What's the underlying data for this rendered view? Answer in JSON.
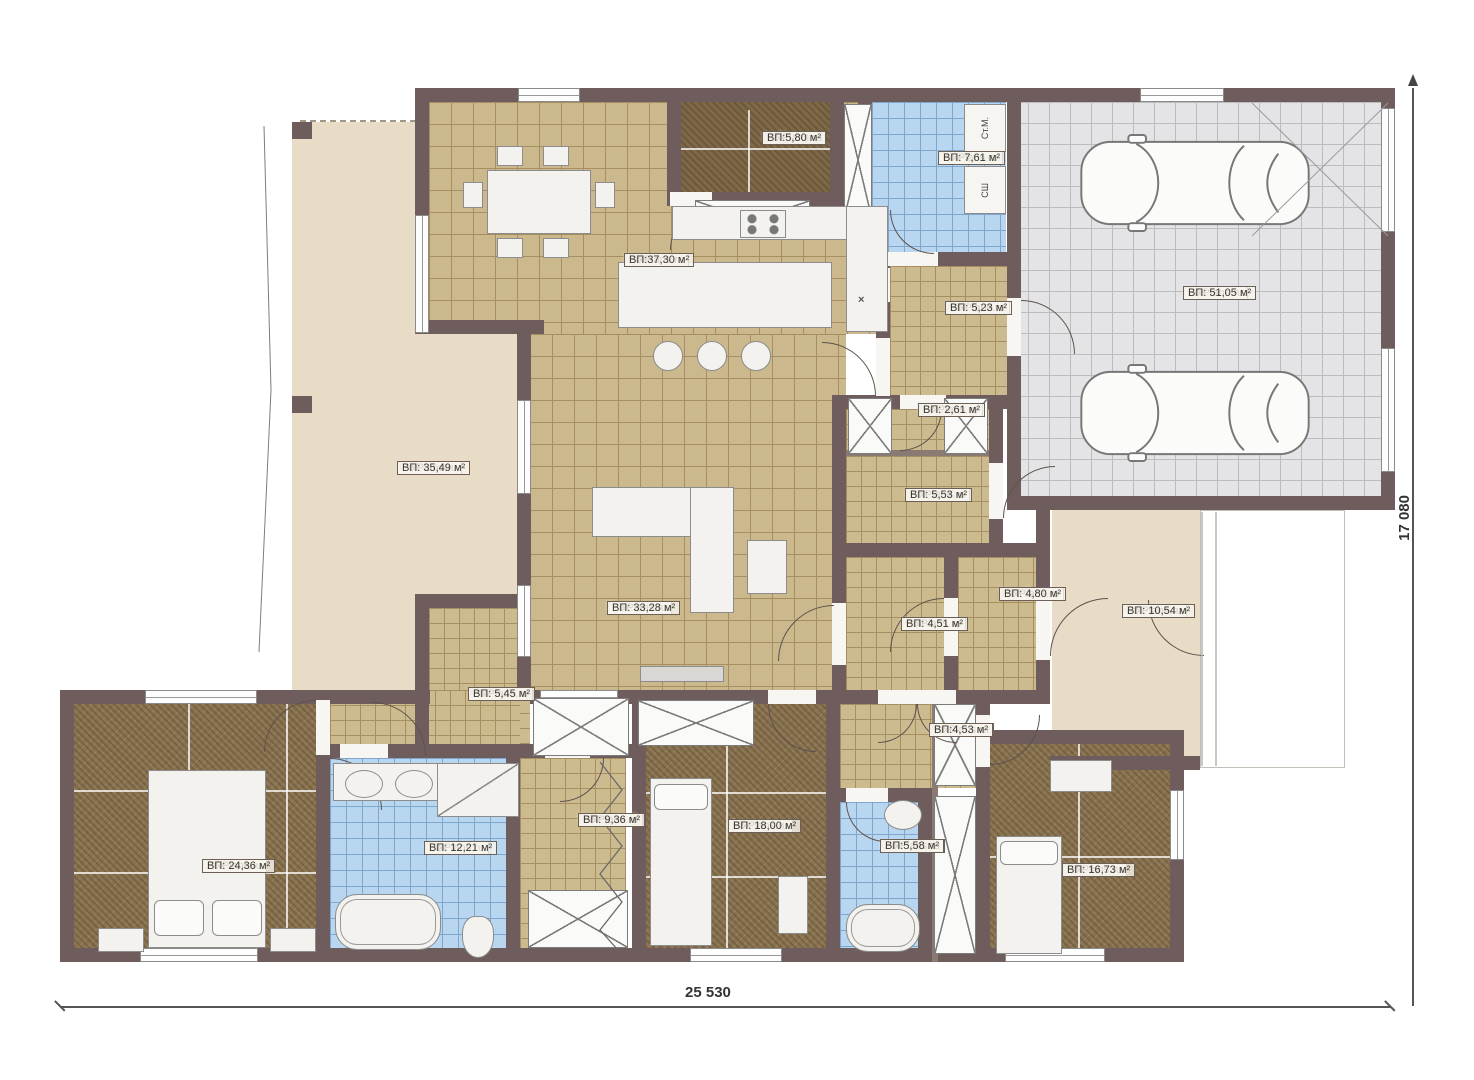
{
  "site": {
    "watermark": "FixPlans.ru"
  },
  "dimensions": {
    "bottom": "25 530",
    "right": "17 080"
  },
  "appliances": [
    {
      "label": "Ст.М.",
      "rect": [
        964,
        104,
        42,
        48
      ]
    },
    {
      "label": "СШ",
      "rect": [
        964,
        166,
        42,
        48
      ]
    }
  ],
  "kitchen_sink_symbol": "×",
  "rooms": [
    {
      "id": "terrace",
      "name": "Терасса",
      "area": "ВП: 35,49 м²",
      "floor": "f-beige",
      "rect": [
        292,
        122,
        238,
        568
      ],
      "label": [
        397,
        460
      ]
    },
    {
      "id": "kitchen",
      "name": "Кухня",
      "area": "ВП:37,30 м²",
      "floor": "f-tan",
      "rect": [
        429,
        102,
        460,
        232
      ],
      "label": [
        624,
        252
      ]
    },
    {
      "id": "kabinet",
      "name": "Кабинет",
      "area": "ВП:5,80 м²",
      "floor": "f-carpetd",
      "rect": [
        681,
        102,
        149,
        90
      ],
      "label": [
        762,
        130
      ]
    },
    {
      "id": "laundry",
      "name": "Прачечная",
      "area": "ВП: 7,61 м²",
      "floor": "f-blue",
      "rect": [
        872,
        102,
        134,
        150
      ],
      "label": [
        938,
        150
      ]
    },
    {
      "id": "garage",
      "name": "Гараж",
      "area": "ВП: 51,05 м²",
      "floor": "f-gray",
      "rect": [
        1007,
        102,
        374,
        394
      ],
      "label": [
        1183,
        285
      ]
    },
    {
      "id": "hall523",
      "name": "Холл",
      "area": "ВП: 5,23 м²",
      "floor": "f-tansm",
      "rect": [
        890,
        266,
        117,
        129
      ],
      "label": [
        945,
        300
      ]
    },
    {
      "id": "klad261",
      "name": "Кладовая",
      "area": "ВП: 2,61 м²",
      "floor": "f-tansm",
      "rect": [
        846,
        409,
        143,
        41
      ],
      "label": [
        918,
        402
      ]
    },
    {
      "id": "klad553",
      "name": "Кладовая",
      "area": "ВП: 5,53 м²",
      "floor": "f-tansm",
      "rect": [
        846,
        456,
        143,
        87
      ],
      "label": [
        905,
        487
      ]
    },
    {
      "id": "gostinaya",
      "name": "Гостиная",
      "area": "ВП: 33,28 м²",
      "floor": "f-tan",
      "rect": [
        530,
        334,
        316,
        356
      ],
      "label": [
        607,
        600
      ]
    },
    {
      "id": "hall451",
      "name": "Холл",
      "area": "ВП: 4,51 м²",
      "floor": "f-tansm",
      "rect": [
        846,
        557,
        98,
        133
      ],
      "label": [
        901,
        616
      ]
    },
    {
      "id": "tambur",
      "name": "Тамбур",
      "area": "ВП: 4,80 м²",
      "floor": "f-tansm",
      "rect": [
        958,
        557,
        78,
        133
      ],
      "label": [
        999,
        586
      ]
    },
    {
      "id": "krylco",
      "name": "Крыльцо",
      "area": "ВП: 10,54 м²",
      "floor": "f-beige",
      "rect": [
        1052,
        510,
        148,
        246
      ],
      "label": [
        1122,
        603
      ]
    },
    {
      "id": "hall545",
      "name": "Холл",
      "area": "ВП: 5,45 м²",
      "floor": "f-tansm",
      "rect": [
        429,
        608,
        101,
        150
      ],
      "label": [
        468,
        686
      ]
    },
    {
      "id": "sp2436",
      "name": "Спальня",
      "area": "ВП: 24,36 м²",
      "floor": "f-carpet",
      "rect": [
        74,
        704,
        242,
        244
      ],
      "label": [
        202,
        858
      ]
    },
    {
      "id": "su1221",
      "name": "С/у",
      "area": "ВП: 12,21 м²",
      "floor": "f-blue",
      "rect": [
        330,
        758,
        176,
        190
      ],
      "label": [
        424,
        840
      ]
    },
    {
      "id": "garderob",
      "name": "Гардероб",
      "area": "ВП: 9,36 м²",
      "floor": "f-tansm",
      "rect": [
        520,
        758,
        106,
        190
      ],
      "label": [
        578,
        812
      ]
    },
    {
      "id": "sp1800",
      "name": "Спальня",
      "area": "ВП: 18,00 м²",
      "floor": "f-carpet",
      "rect": [
        646,
        704,
        180,
        244
      ],
      "label": [
        728,
        818
      ]
    },
    {
      "id": "hall453",
      "name": "Холл",
      "area": "ВП:4,53 м²",
      "floor": "f-tansm",
      "rect": [
        840,
        704,
        150,
        84
      ],
      "label": [
        929,
        722
      ]
    },
    {
      "id": "su558",
      "name": "С/у",
      "area": "ВП:5,58 м²",
      "floor": "f-blue",
      "rect": [
        840,
        802,
        78,
        146
      ],
      "label": [
        880,
        838
      ]
    },
    {
      "id": "sp1673",
      "name": "Спальня",
      "area": "ВП: 16,73 м²",
      "floor": "f-carpet",
      "rect": [
        990,
        744,
        180,
        204
      ],
      "label": [
        1062,
        862
      ]
    }
  ],
  "extra_floors": [
    {
      "floor": "f-tansm",
      "rect": [
        330,
        690,
        190,
        68
      ]
    }
  ],
  "walls": [
    [
      415,
      88,
      980,
      14
    ],
    [
      1381,
      88,
      14,
      422
    ],
    [
      1007,
      496,
      388,
      14
    ],
    [
      415,
      88,
      14,
      246
    ],
    [
      417,
      320,
      127,
      14
    ],
    [
      517,
      334,
      14,
      356
    ],
    [
      667,
      102,
      14,
      104
    ],
    [
      830,
      102,
      14,
      104
    ],
    [
      667,
      192,
      177,
      14
    ],
    [
      858,
      102,
      14,
      164
    ],
    [
      858,
      252,
      149,
      14
    ],
    [
      876,
      254,
      14,
      146
    ],
    [
      1007,
      88,
      14,
      422
    ],
    [
      832,
      395,
      175,
      14
    ],
    [
      832,
      395,
      14,
      295
    ],
    [
      989,
      409,
      14,
      148
    ],
    [
      832,
      543,
      218,
      14
    ],
    [
      944,
      557,
      14,
      133
    ],
    [
      1036,
      510,
      14,
      180
    ],
    [
      60,
      690,
      370,
      14
    ],
    [
      530,
      690,
      520,
      14
    ],
    [
      60,
      690,
      14,
      272
    ],
    [
      60,
      948,
      1124,
      14
    ],
    [
      316,
      690,
      14,
      272
    ],
    [
      330,
      744,
      302,
      14
    ],
    [
      506,
      758,
      14,
      204
    ],
    [
      632,
      690,
      14,
      272
    ],
    [
      826,
      690,
      14,
      272
    ],
    [
      840,
      788,
      92,
      14
    ],
    [
      918,
      802,
      14,
      146
    ],
    [
      976,
      704,
      14,
      258
    ],
    [
      990,
      730,
      194,
      14
    ],
    [
      1050,
      756,
      150,
      14
    ],
    [
      1170,
      744,
      14,
      218
    ],
    [
      415,
      594,
      115,
      14
    ],
    [
      415,
      594,
      14,
      164
    ]
  ],
  "thin_walls": [
    [
      846,
      450,
      143,
      6
    ],
    [
      932,
      690,
      6,
      272
    ]
  ],
  "windows": [
    [
      518,
      88,
      62,
      14,
      "h"
    ],
    [
      1140,
      88,
      84,
      14,
      "h"
    ],
    [
      415,
      215,
      14,
      118,
      "v"
    ],
    [
      517,
      400,
      14,
      94,
      "v"
    ],
    [
      517,
      585,
      14,
      72,
      "v"
    ],
    [
      145,
      690,
      112,
      14,
      "h"
    ],
    [
      540,
      690,
      78,
      14,
      "h"
    ],
    [
      140,
      948,
      118,
      14,
      "h"
    ],
    [
      690,
      948,
      92,
      14,
      "h"
    ],
    [
      1005,
      948,
      100,
      14,
      "h"
    ],
    [
      1170,
      790,
      14,
      70,
      "v"
    ],
    [
      1381,
      108,
      14,
      124,
      "v"
    ],
    [
      1381,
      348,
      14,
      124,
      "v"
    ]
  ],
  "gaps": [
    [
      876,
      338,
      14,
      58
    ],
    [
      888,
      252,
      50,
      14
    ],
    [
      1007,
      298,
      14,
      58
    ],
    [
      900,
      395,
      46,
      14
    ],
    [
      989,
      463,
      14,
      56
    ],
    [
      944,
      598,
      14,
      58
    ],
    [
      1036,
      598,
      14,
      62
    ],
    [
      832,
      603,
      14,
      62
    ],
    [
      316,
      700,
      14,
      55
    ],
    [
      340,
      744,
      48,
      14
    ],
    [
      545,
      744,
      45,
      14
    ],
    [
      768,
      690,
      48,
      14
    ],
    [
      878,
      690,
      78,
      14
    ],
    [
      976,
      715,
      14,
      52
    ],
    [
      846,
      788,
      42,
      14
    ],
    [
      670,
      192,
      42,
      14
    ],
    [
      876,
      268,
      14,
      34
    ]
  ],
  "arcs": [
    [
      822,
      342,
      54,
      "tr"
    ],
    [
      890,
      210,
      44,
      "bl"
    ],
    [
      1021,
      300,
      54,
      "tr"
    ],
    [
      900,
      409,
      42,
      "br"
    ],
    [
      1003,
      466,
      52,
      "tl"
    ],
    [
      890,
      598,
      54,
      "tl"
    ],
    [
      1050,
      598,
      58,
      "tl"
    ],
    [
      778,
      605,
      56,
      "tl"
    ],
    [
      372,
      702,
      54,
      "tr"
    ],
    [
      330,
      758,
      52,
      "tr"
    ],
    [
      768,
      704,
      48,
      "bl"
    ],
    [
      878,
      704,
      39,
      "br"
    ],
    [
      917,
      704,
      39,
      "bl"
    ],
    [
      990,
      715,
      50,
      "br"
    ],
    [
      846,
      802,
      40,
      "bl"
    ],
    [
      264,
      700,
      52,
      "tl"
    ],
    [
      560,
      758,
      44,
      "br"
    ],
    [
      1148,
      600,
      56,
      "bl"
    ],
    [
      670,
      206,
      44,
      "tl"
    ]
  ],
  "xboxes": [
    [
      844,
      104,
      28,
      112
    ],
    [
      695,
      200,
      115,
      40
    ],
    [
      848,
      398,
      44,
      56
    ],
    [
      944,
      398,
      44,
      56
    ],
    [
      533,
      698,
      96,
      58
    ],
    [
      528,
      890,
      100,
      58
    ],
    [
      638,
      700,
      116,
      46
    ],
    [
      934,
      704,
      42,
      82
    ],
    [
      934,
      796,
      42,
      158
    ]
  ],
  "seams": [
    [
      74,
      790,
      242,
      2
    ],
    [
      74,
      872,
      242,
      2
    ],
    [
      188,
      704,
      2,
      244
    ],
    [
      286,
      704,
      2,
      244
    ],
    [
      646,
      792,
      180,
      2
    ],
    [
      646,
      876,
      180,
      2
    ],
    [
      726,
      704,
      2,
      244
    ],
    [
      990,
      856,
      180,
      2
    ],
    [
      1078,
      744,
      2,
      204
    ],
    [
      681,
      148,
      149,
      2
    ],
    [
      748,
      110,
      2,
      86
    ]
  ],
  "furniture": [
    {
      "t": "table",
      "r": [
        487,
        170,
        104,
        64
      ]
    },
    {
      "t": "chair",
      "r": [
        497,
        146,
        26,
        20
      ]
    },
    {
      "t": "chair",
      "r": [
        543,
        146,
        26,
        20
      ]
    },
    {
      "t": "chair",
      "r": [
        497,
        238,
        26,
        20
      ]
    },
    {
      "t": "chair",
      "r": [
        543,
        238,
        26,
        20
      ]
    },
    {
      "t": "chair",
      "r": [
        463,
        182,
        20,
        26
      ]
    },
    {
      "t": "chair",
      "r": [
        595,
        182,
        20,
        26
      ]
    },
    {
      "t": "island",
      "r": [
        618,
        262,
        214,
        66
      ]
    },
    {
      "t": "stool",
      "r": [
        653,
        341,
        30,
        30
      ]
    },
    {
      "t": "stool",
      "r": [
        697,
        341,
        30,
        30
      ]
    },
    {
      "t": "stool",
      "r": [
        741,
        341,
        30,
        30
      ]
    },
    {
      "t": "counter",
      "r": [
        672,
        206,
        190,
        34
      ]
    },
    {
      "t": "stove",
      "r": [
        740,
        210,
        46,
        28
      ]
    },
    {
      "t": "counter",
      "r": [
        846,
        206,
        42,
        126
      ]
    },
    {
      "t": "car",
      "r": [
        1076,
        134,
        238,
        98
      ]
    },
    {
      "t": "car",
      "r": [
        1076,
        364,
        238,
        98
      ]
    },
    {
      "t": "sofa",
      "r": [
        592,
        487,
        142,
        50
      ]
    },
    {
      "t": "sofa",
      "r": [
        690,
        487,
        44,
        126
      ]
    },
    {
      "t": "ctable",
      "r": [
        747,
        540,
        40,
        54
      ]
    },
    {
      "t": "tv",
      "r": [
        640,
        666,
        84,
        16
      ]
    },
    {
      "t": "bed",
      "r": [
        148,
        770,
        118,
        178
      ]
    },
    {
      "t": "pillow",
      "r": [
        154,
        900,
        50,
        36
      ]
    },
    {
      "t": "pillow",
      "r": [
        212,
        900,
        50,
        36
      ]
    },
    {
      "t": "nstand",
      "r": [
        98,
        928,
        46,
        24
      ]
    },
    {
      "t": "nstand",
      "r": [
        270,
        928,
        46,
        24
      ]
    },
    {
      "t": "counter",
      "r": [
        333,
        763,
        110,
        38
      ]
    },
    {
      "t": "sink",
      "r": [
        345,
        770,
        38,
        28
      ]
    },
    {
      "t": "sink",
      "r": [
        395,
        770,
        38,
        28
      ]
    },
    {
      "t": "shower",
      "r": [
        437,
        763,
        82,
        54
      ]
    },
    {
      "t": "bath",
      "r": [
        335,
        894,
        106,
        56
      ]
    },
    {
      "t": "toilet",
      "r": [
        462,
        916,
        32,
        42
      ]
    },
    {
      "t": "bed",
      "r": [
        650,
        778,
        62,
        168
      ]
    },
    {
      "t": "pillow",
      "r": [
        654,
        784,
        54,
        26
      ]
    },
    {
      "t": "nstand",
      "r": [
        778,
        876,
        30,
        58
      ]
    },
    {
      "t": "sink",
      "r": [
        884,
        800,
        38,
        30
      ]
    },
    {
      "t": "bath",
      "r": [
        846,
        904,
        74,
        48
      ]
    },
    {
      "t": "bed",
      "r": [
        996,
        836,
        66,
        118
      ]
    },
    {
      "t": "pillow",
      "r": [
        1000,
        841,
        58,
        24
      ]
    },
    {
      "t": "nstand",
      "r": [
        1050,
        760,
        62,
        32
      ]
    }
  ],
  "columns": [
    [
      292,
      122,
      20,
      17
    ],
    [
      292,
      396,
      20,
      17
    ]
  ]
}
